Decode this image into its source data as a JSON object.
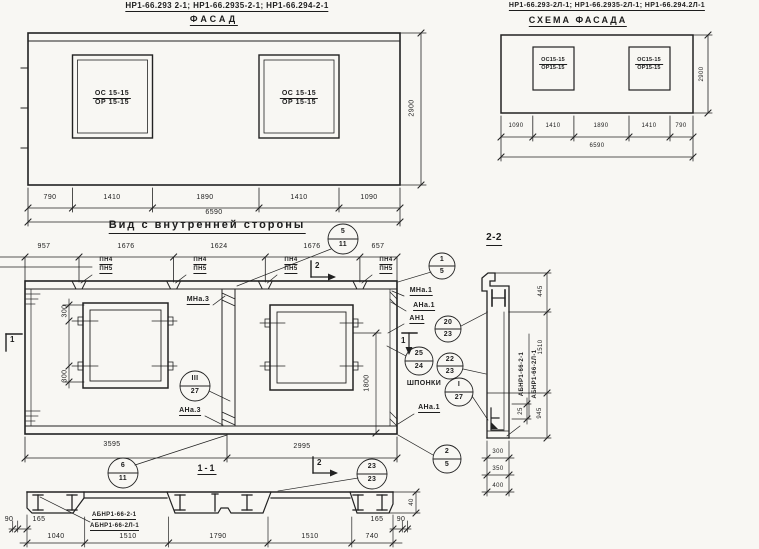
{
  "colors": {
    "ink": "#1d1d1d",
    "paper": "#f8f7f3"
  },
  "facade": {
    "codes": "НР1-66.293 2-1; НР1-66.2935-2-1; НР1-66.294-2-1",
    "title": "ФАСАД",
    "window_mark_top": "ОС 15-15",
    "window_mark_bottom": "ОР 15-15",
    "dims": [
      "790",
      "1410",
      "1890",
      "1410",
      "1090"
    ],
    "total": "6590",
    "height": "2900"
  },
  "scheme": {
    "codes": "НР1-66.293-2Л-1; НР1-66.2935-2Л-1; НР1-66.294.2Л-1",
    "title": "СХЕМА ФАСАДА",
    "window_mark_top": "ОС15-15",
    "window_mark_bottom": "ОР15-15",
    "dims": [
      "1090",
      "1410",
      "1890",
      "1410",
      "790"
    ],
    "total": "6590",
    "height": "2900"
  },
  "inner_view": {
    "title": "Вид с внутренней стороны",
    "top_dims": [
      "957",
      "1676",
      "1624",
      "1676",
      "657"
    ],
    "pn_top": "ПН4",
    "pn_bottom": "ПН5",
    "side_dim_upper": "300",
    "side_dim_lower": "300",
    "window_height_dim": "1800",
    "bottom_dims": [
      "3595",
      "2995"
    ],
    "labels": {
      "mna3": "МНа.3",
      "ana3": "АНа.3",
      "mna1": "МНа.1",
      "ana1": "АНа.1",
      "an1": "АН1",
      "shponki": "ШПОНКИ",
      "ana1_lower": "АНа.1"
    },
    "marker_1": "1",
    "marker_2": "2",
    "callouts": {
      "c5_11": {
        "num": "5",
        "den": "11"
      },
      "c1_5": {
        "num": "1",
        "den": "5"
      },
      "c20_23": {
        "num": "20",
        "den": "23"
      },
      "c25_24": {
        "num": "25",
        "den": "24"
      },
      "c22_23": {
        "num": "22",
        "den": "23"
      },
      "cI_27": {
        "num": "I",
        "den": "27"
      },
      "cIII_27": {
        "num": "III",
        "den": "27"
      },
      "c2_5": {
        "num": "2",
        "den": "5"
      },
      "c6_11": {
        "num": "6",
        "den": "11"
      },
      "c23_23": {
        "num": "23",
        "den": "23"
      }
    }
  },
  "section_1_1": {
    "title": "1-1",
    "beam_code_top": "АБНР1-66-2-1",
    "beam_code_bottom": "АБНР1-66-2Л-1",
    "left_dims": [
      "90",
      "165"
    ],
    "bottom_dims": [
      "1040",
      "1510",
      "1790",
      "1510",
      "740"
    ],
    "right_dims": [
      "165",
      "90"
    ],
    "thickness_dim": "40"
  },
  "section_2_2": {
    "title": "2-2",
    "beam_code_top": "АБНР1-66-2-1",
    "beam_code_bottom": "АБНР1-66-2Л-1",
    "dim_top": "445",
    "dim_middle": "1510",
    "dim_bottom": "945",
    "dim_small": "25",
    "stack_dims": [
      "300",
      "350",
      "400"
    ]
  }
}
